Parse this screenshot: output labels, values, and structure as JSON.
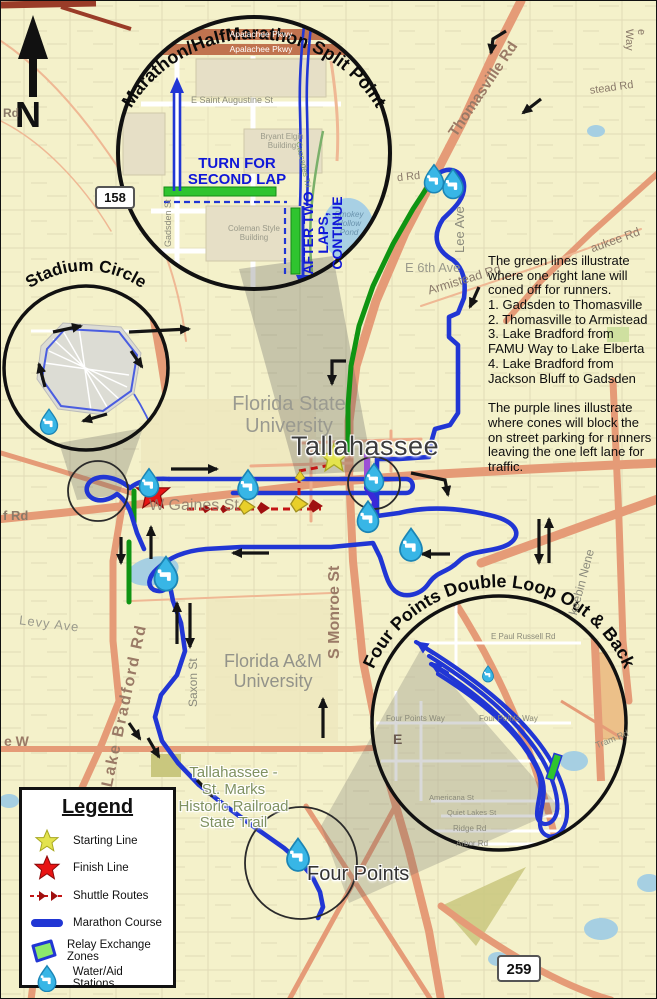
{
  "compass": {
    "label": "N"
  },
  "shields": {
    "route_158": "158",
    "route_259": "259"
  },
  "region_labels": {
    "city": "Tallahassee",
    "fsu": "Florida State\nUniversity",
    "famu": "Florida A&M\nUniversity",
    "st_marks": "Tallahassee -\nSt. Marks\nHistoric Railroad\nState Trail",
    "four_points": "Four Points"
  },
  "streets": {
    "thomasville": "Thomasville Rd",
    "armistead": "Armistead Rd",
    "lee": "Lee Ave",
    "e6th": "E 6th Ave",
    "aukee": "aukee Rd",
    "stead": "stead Rd",
    "e_way": "e Way",
    "d_rd": "d Rd",
    "rd_frag": "Rd",
    "f_rd": "f Rd",
    "gaines": "W Gaines St",
    "monroe": "S Monroe St",
    "saxon": "Saxon St",
    "lake_bradford": "Lake Bradford Rd",
    "levy": "Levy Ave",
    "keebin": "keebin Nene",
    "ave_w": "e W",
    "e_frag": "E"
  },
  "insets": {
    "split_point": {
      "title": "Marathon/HalfMarathon Split Point",
      "turn_label": "TURN FOR\nSECOND LAP",
      "continue_label": "AFTER TWO LAPS,\nCONTINUE",
      "streets": {
        "apalachee1": "Apalachee Pkwy",
        "apalachee2": "Apalachee Pkwy",
        "augustine": "E Saint Augustine St",
        "gadsden": "Gadsden St",
        "cascades": "Cascades Trl",
        "bryant": "Bryant Elgin\nBuilding",
        "coleman": "Coleman Style\nBuilding",
        "pond": "Smokey\nHollow\nPond"
      }
    },
    "stadium": {
      "title": "Stadium Circle"
    },
    "four_points": {
      "title": "Four Points Double Loop Out & Back",
      "streets": {
        "paul_russell": "E Paul Russell Rd",
        "four_points_way_w": "Four Points Way",
        "four_points_way_e": "Four Points Way",
        "ridge": "Ridge Rd",
        "arbor": "Arbor Rd",
        "tram": "Tram Rd",
        "americana": "Americana St",
        "quiet_lakes": "Quiet Lakes St"
      }
    }
  },
  "notes": {
    "green_text": "The green lines illustrate\nwhere one right lane will\nconed off for runners.\n1. Gadsden to Thomasville\n2. Thomasville to Armistead\n3. Lake Bradford from\nFAMU Way to Lake Elberta\n4. Lake Bradford from\nJackson Bluff to Gadsden",
    "purple_text": "The purple lines illustrate\nwhere cones will block the\non street parking for runners\nleaving the one left lane for\ntraffic."
  },
  "legend": {
    "title": "Legend",
    "items": [
      {
        "icon": "starting-line-star",
        "label": "Starting Line"
      },
      {
        "icon": "finish-line-star",
        "label": "Finish Line"
      },
      {
        "icon": "shuttle-route-dashes",
        "label": "Shuttle Routes"
      },
      {
        "icon": "marathon-course-line",
        "label": "Marathon Course"
      },
      {
        "icon": "relay-exchange-zone",
        "label": "Relay Exchange Zones"
      },
      {
        "icon": "water-aid-drop",
        "label": "Water/Aid Stations"
      }
    ]
  },
  "colors": {
    "course_blue": "#2136d4",
    "coned_green": "#0f9412",
    "parking_purple": "#9c50d6",
    "shuttle_red": "#c41414",
    "water_drop": "#38b6e6",
    "start_yellow": "#e3e34e",
    "finish_red": "#e81414"
  }
}
